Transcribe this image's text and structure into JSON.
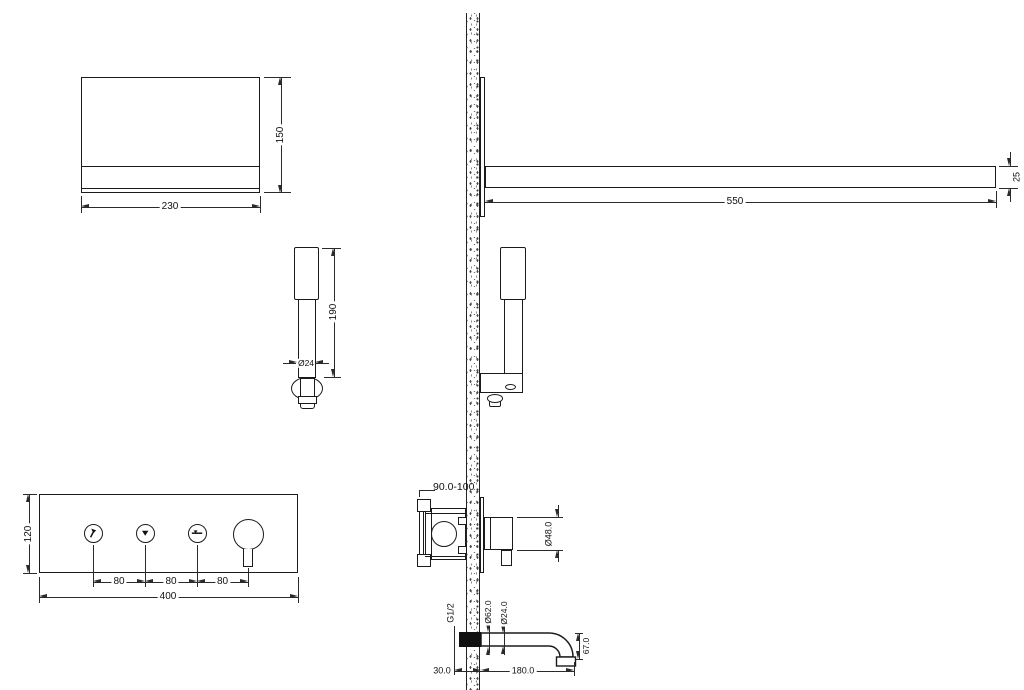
{
  "drawing": {
    "title": "Shower system installation drawing",
    "colors": {
      "line": "#1b1b1b",
      "dimension": "#2a2a2a",
      "background": "#ffffff"
    },
    "views": {
      "overhead": {
        "name": "overhead-shower-side-view",
        "width": "230",
        "height": "150"
      },
      "handshower": {
        "name": "hand-shower-detail",
        "height": "190",
        "diameter": "Ø24"
      },
      "panel": {
        "name": "thermostat-control-panel",
        "width": "400",
        "height": "120",
        "pitch1": "80",
        "pitch2": "80",
        "pitch3": "80",
        "buttons": [
          {
            "icon": "handshower-icon"
          },
          {
            "icon": "rainshower-icon"
          },
          {
            "icon": "spout-icon"
          }
        ]
      },
      "arm": {
        "name": "ceiling-arm-installed",
        "length": "550",
        "profile": "25"
      },
      "valve": {
        "name": "concealed-valve-section",
        "rough_in": "90.0-100",
        "handle": "Ø48.0"
      },
      "spout": {
        "name": "bath-spout-section",
        "thread": "G1/2",
        "flange": "Ø62.0",
        "pipe": "Ø24.0",
        "inset": "30.0",
        "reach": "180.0",
        "drop": "67.0"
      }
    }
  }
}
